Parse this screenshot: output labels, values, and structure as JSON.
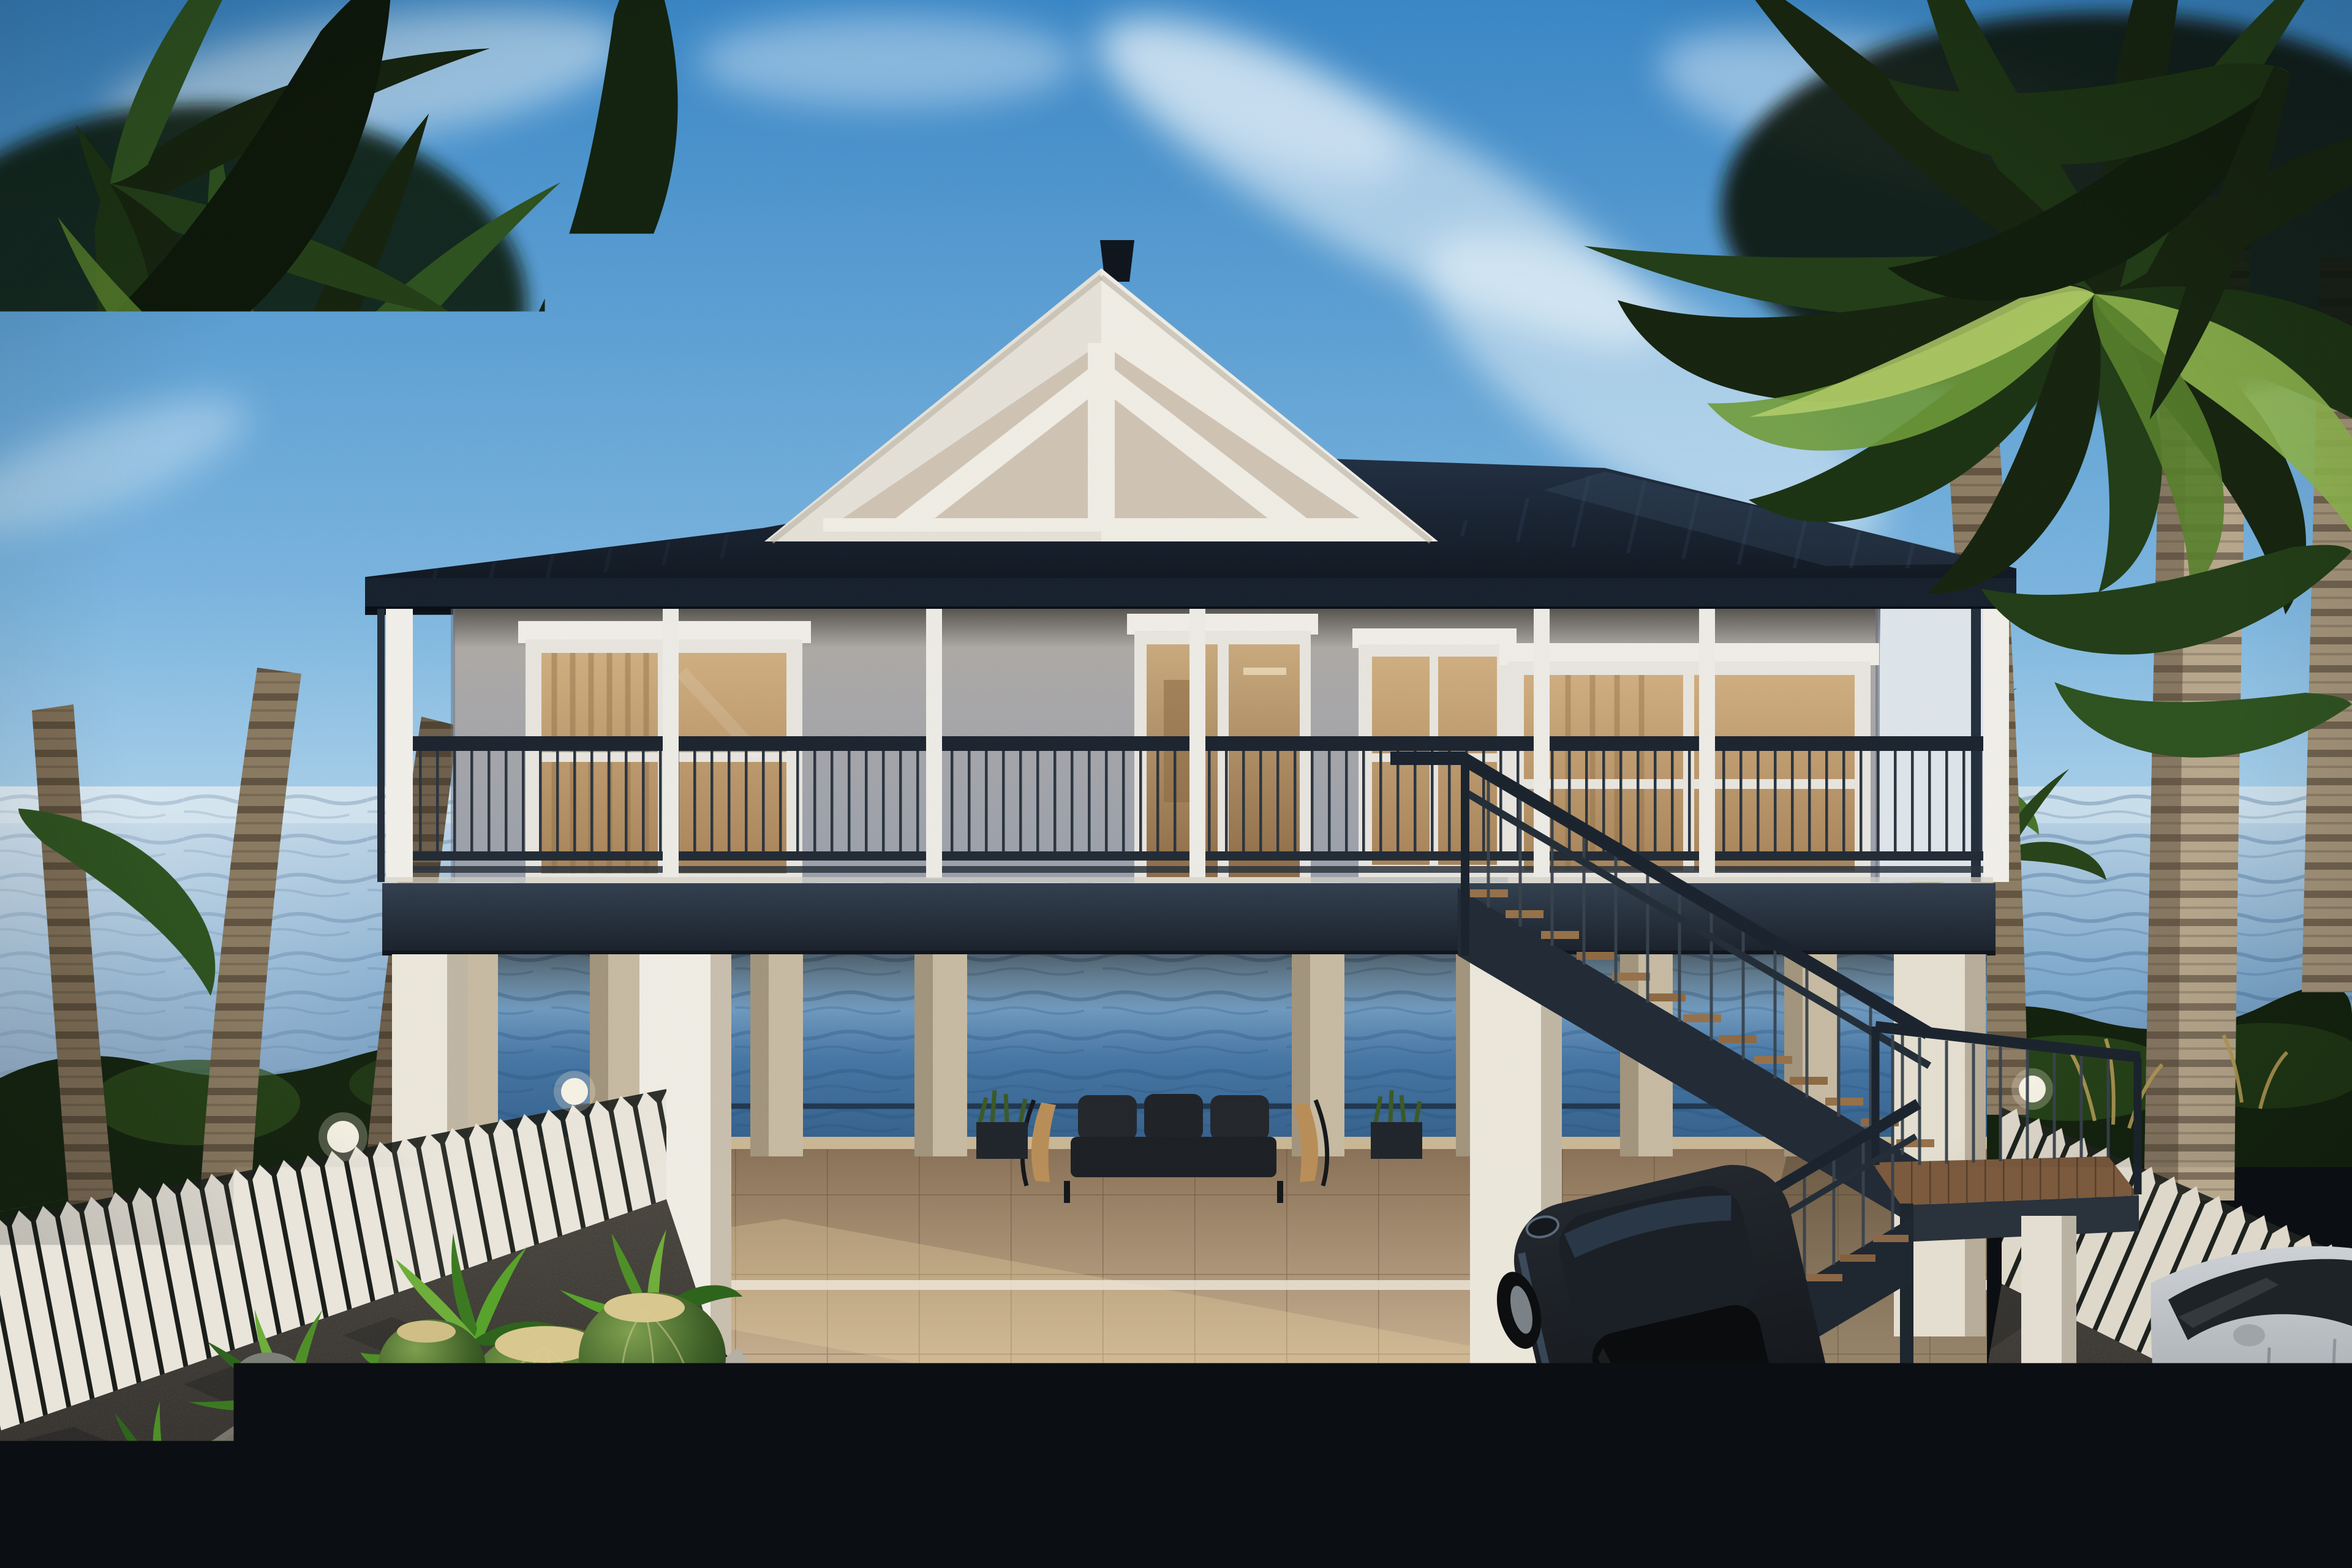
{
  "scene": {
    "type": "photorealistic 3d architectural rendering",
    "subject": "two-story coastal beach house on white pilings with wraparound balcony, dark metal roof, decorative gable truss, exterior switchback staircase, ocean visible beneath and behind the house",
    "environment": "tropical waterfront lot framed by tall palm trees, white picket fences on both sides, wet dark driveway in front",
    "foreground": "barrel-cactus and fern planter bed with boulders at lower left; black sedan and silver car parked at lower right",
    "lighting": "bright sunny day, sun from upper left, wispy clouds in blue sky",
    "house": {
      "gable": "white triangular gable with beige recessed truss panels and small dark finial",
      "windows": "warm amber-lit windows with white trim and wood curtains",
      "balcony": "dark metal railing with thin vertical balusters on charcoal deck band",
      "undercroft": "beige square pilings over tiled patio with dark outdoor sofa facing the water",
      "stairs": "dark steel switchback staircase with wood treads and landing on white support pier"
    },
    "cars": [
      {
        "name": "black-sedan",
        "view": "rear three-quarter from above",
        "details": "red taillights, blank white license plate, sunroof, alloy wheels"
      },
      {
        "name": "silver-car",
        "view": "front-left partial at right edge",
        "details": "dark glass, black alloy wheel, chrome running board"
      }
    ],
    "license_plate_text": ""
  },
  "counts": {
    "porch_columns": 7,
    "balcony_windows": 3,
    "french_doors": 1,
    "front_piers": 4,
    "back_pilings": 8,
    "left_palm_trunks": 4,
    "right_palm_trunks": 3,
    "barrel_cacti": 6,
    "boulders": 5,
    "fence_lamps": 3,
    "stair_flights": 2,
    "cars": 2
  },
  "palette": {
    "sky_top": "#3a87c6",
    "sky_horizon": "#c4dff0",
    "cloud": "#f4f9fc",
    "ocean_deep": "#466f9c",
    "ocean_haze": "#c2d8e8",
    "water_under": "#4676a4",
    "roof_dark": "#0d1219",
    "roof_fascia": "#18222e",
    "gable_white": "#efece4",
    "gable_panel": "#cfc3b4",
    "wall_gray": "#aaa8a6",
    "side_wall_light": "#dde4ea",
    "column_white": "#eceae4",
    "window_glow": "#c9a87a",
    "railing_dark": "#1d2530",
    "deck_band": "#232c38",
    "piling_white": "#ebe6da",
    "piling_beige": "#c7baa3",
    "patio_tan": "#c8b192",
    "fence_white": "#e9e5db",
    "shrub_dark": "#152410",
    "palm_green_dark": "#16240f",
    "palm_green_light": "#8fb64e",
    "trunk_tan": "#b7a78c",
    "ground_asphalt": "#2e2b27",
    "soil_dark": "#2b241c",
    "cactus_green": "#4a6b35",
    "cactus_crown": "#d8c78f",
    "rock_gray": "#787d72",
    "car_black": "#15181c",
    "car_silver": "#b9bcc0",
    "taillight_red": "#c0242c",
    "license_plate": "#e9e9e7",
    "sofa_dark": "#24282c"
  }
}
